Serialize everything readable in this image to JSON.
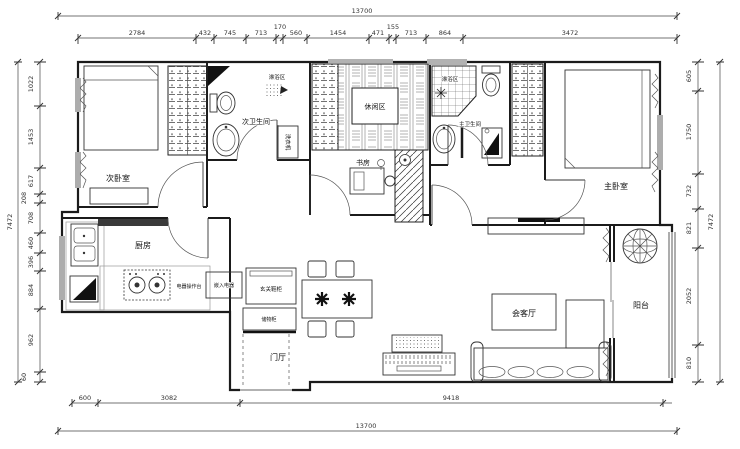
{
  "dims": {
    "top_total": "13700",
    "top": [
      "2784",
      "432",
      "745",
      "713",
      "170",
      "560",
      "1454",
      "471",
      "155",
      "713",
      "864",
      "3472"
    ],
    "left_total": "7472",
    "left": [
      "1022",
      "1453",
      "617",
      "208",
      "708",
      "460",
      "396",
      "884",
      "962",
      "60"
    ],
    "right_total": "7472",
    "right": [
      "605",
      "1750",
      "732",
      "821",
      "2052",
      "810"
    ],
    "bottom": [
      "600",
      "3082",
      "9418"
    ],
    "bottom_total": "13700"
  },
  "labels": {
    "secondary_bedroom": "次卧室",
    "secondary_bathroom": "次卫生间",
    "shower_area_1": "淋浴区",
    "washing_machine": "洗衣机",
    "leisure_area": "休闲区",
    "study": "书房",
    "shower_area_2": "淋浴区",
    "master_bathroom": "主卫生间",
    "master_bedroom": "主卧室",
    "kitchen": "厨房",
    "appliance_counter": "电器操作台",
    "built_in_appliance": "嵌入电器",
    "entry_cabinet": "玄关鞋柜",
    "storage_cabinet": "储物柜",
    "entry_hall": "门厅",
    "living_room": "会客厅",
    "balcony": "阳台"
  },
  "colors": {
    "line": "#1b1b1b",
    "dim": "#333333",
    "fill_dark": "#111111"
  }
}
